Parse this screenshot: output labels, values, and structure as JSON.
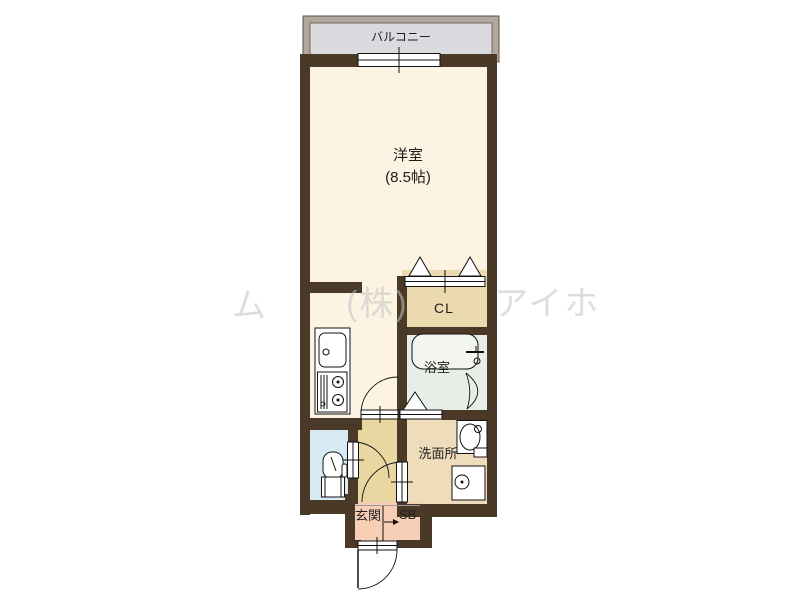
{
  "floorplan": {
    "balcony_label": "バルコニー",
    "main_room_label": "洋室",
    "main_room_size": "(8.5帖)",
    "closet_label": "CL",
    "bathroom_label": "浴室",
    "washroom_label": "洗面所",
    "entrance_label": "玄関",
    "shoebox_label": "SB",
    "watermark": {
      "w1": "ム",
      "w2": "(株)",
      "w3": "アイホ"
    },
    "colors": {
      "wall": "#4A3926",
      "main_room": "#FDF3E3",
      "closet": "#EBD9B0",
      "hallway": "#E9D7A2",
      "washroom": "#EEDCBB",
      "entrance": "#F7CEB6",
      "toilet": "#D8EBF2",
      "bathroom": "#E7EEE7",
      "balcony_floor": "#DBDADF",
      "balcony_frame": "#B2A89D"
    }
  }
}
